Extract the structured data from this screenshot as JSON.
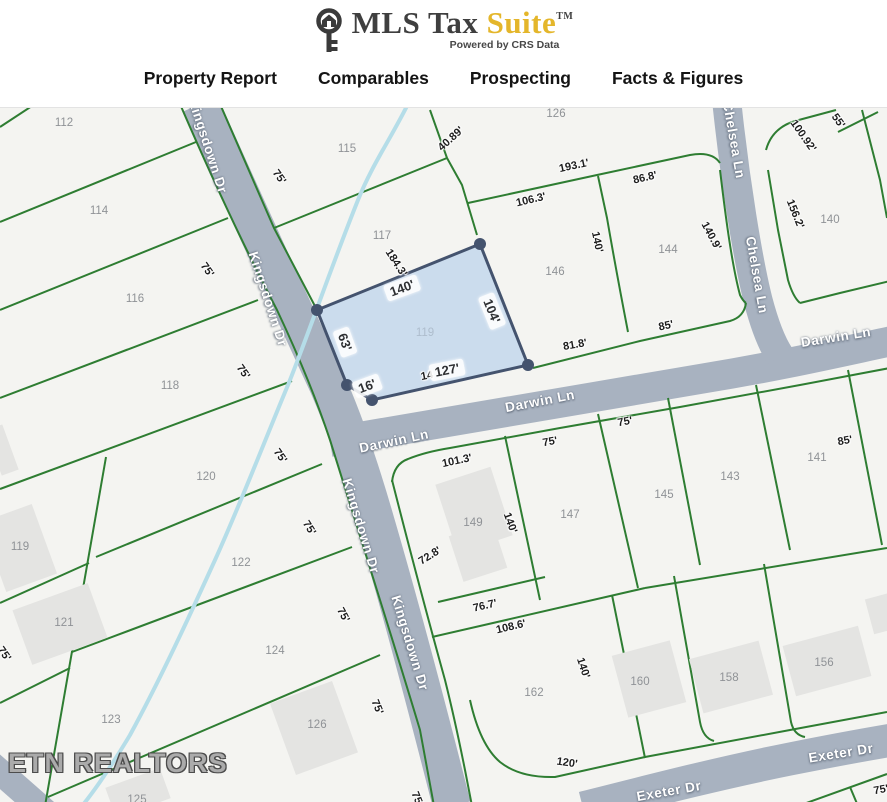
{
  "header": {
    "logo": {
      "brand_primary": "MLS Tax",
      "brand_accent": "Suite",
      "trademark": "TM",
      "tagline": "Powered by CRS Data"
    },
    "nav": [
      {
        "label": "Property Report"
      },
      {
        "label": "Comparables"
      },
      {
        "label": "Prospecting"
      },
      {
        "label": "Facts & Figures"
      }
    ]
  },
  "map": {
    "watermark": "ETN REALTORS",
    "selected_parcel": {
      "number": "119",
      "frontage_street": "Darwin Ln",
      "dimensions": [
        "140'",
        "104'",
        "127'",
        "16'",
        "63'"
      ]
    },
    "colors": {
      "accent_gold": "#e4b62b",
      "road": "#a8b2c0",
      "parcel_line": "#2e7d32",
      "creek": "#b5dde8",
      "selection_fill": "#a9c9ea",
      "selection_border": "#44536e",
      "map_background": "#f4f4f1"
    },
    "streets": [
      {
        "name": "Kingsdown Dr",
        "labels": [
          [
            208,
            146,
            72
          ],
          [
            268,
            299,
            72
          ],
          [
            361,
            526,
            73
          ],
          [
            410,
            643,
            73
          ]
        ]
      },
      {
        "name": "Darwin Ln",
        "labels": [
          [
            394,
            441,
            -12
          ],
          [
            540,
            401,
            -11
          ],
          [
            836,
            337,
            -9
          ]
        ]
      },
      {
        "name": "Chelsea Ln",
        "labels": [
          [
            734,
            140,
            80
          ],
          [
            757,
            275,
            80
          ]
        ]
      },
      {
        "name": "Exeter Dr",
        "labels": [
          [
            841,
            753,
            -9
          ],
          [
            669,
            791,
            -10
          ]
        ]
      }
    ],
    "parcel_numbers": [
      {
        "n": "112",
        "x": 64,
        "y": 123
      },
      {
        "n": "114",
        "x": 99,
        "y": 211
      },
      {
        "n": "115",
        "x": 347,
        "y": 149
      },
      {
        "n": "116",
        "x": 135,
        "y": 299
      },
      {
        "n": "117",
        "x": 382,
        "y": 236
      },
      {
        "n": "118",
        "x": 170,
        "y": 386
      },
      {
        "n": "119",
        "x": 20,
        "y": 547
      },
      {
        "n": "119",
        "x": 425,
        "y": 333,
        "faint": true
      },
      {
        "n": "120",
        "x": 206,
        "y": 477
      },
      {
        "n": "121",
        "x": 64,
        "y": 623
      },
      {
        "n": "122",
        "x": 241,
        "y": 563
      },
      {
        "n": "123",
        "x": 111,
        "y": 720
      },
      {
        "n": "124",
        "x": 275,
        "y": 651
      },
      {
        "n": "125",
        "x": 137,
        "y": 800
      },
      {
        "n": "126",
        "x": 556,
        "y": 114
      },
      {
        "n": "126",
        "x": 317,
        "y": 725
      },
      {
        "n": "140",
        "x": 830,
        "y": 220
      },
      {
        "n": "141",
        "x": 817,
        "y": 458
      },
      {
        "n": "143",
        "x": 730,
        "y": 477
      },
      {
        "n": "144",
        "x": 668,
        "y": 250
      },
      {
        "n": "145",
        "x": 664,
        "y": 495
      },
      {
        "n": "146",
        "x": 555,
        "y": 272
      },
      {
        "n": "147",
        "x": 570,
        "y": 515
      },
      {
        "n": "149",
        "x": 473,
        "y": 523
      },
      {
        "n": "156",
        "x": 824,
        "y": 663
      },
      {
        "n": "158",
        "x": 729,
        "y": 678
      },
      {
        "n": "160",
        "x": 640,
        "y": 682
      },
      {
        "n": "162",
        "x": 534,
        "y": 693
      }
    ],
    "dimensions": [
      {
        "t": "40.89'",
        "x": 451,
        "y": 139,
        "r": -42
      },
      {
        "t": "193.1'",
        "x": 574,
        "y": 166,
        "r": -12
      },
      {
        "t": "106.3'",
        "x": 531,
        "y": 200,
        "r": -13
      },
      {
        "t": "86.8'",
        "x": 645,
        "y": 178,
        "r": -13
      },
      {
        "t": "140'",
        "x": 597,
        "y": 242,
        "r": 78
      },
      {
        "t": "140.9'",
        "x": 711,
        "y": 236,
        "r": 62
      },
      {
        "t": "100.92'",
        "x": 803,
        "y": 136,
        "r": 55
      },
      {
        "t": "55'",
        "x": 838,
        "y": 121,
        "r": 55
      },
      {
        "t": "156.2'",
        "x": 795,
        "y": 214,
        "r": 68
      },
      {
        "t": "85'",
        "x": 666,
        "y": 326,
        "r": -12
      },
      {
        "t": "81.8'",
        "x": 575,
        "y": 345,
        "r": -10
      },
      {
        "t": "184.3'",
        "x": 396,
        "y": 263,
        "r": 57
      },
      {
        "t": "14",
        "x": 427,
        "y": 376,
        "r": -11
      },
      {
        "t": "140'",
        "x": 402,
        "y": 288,
        "r": -20,
        "boxed": true
      },
      {
        "t": "104'",
        "x": 492,
        "y": 311,
        "r": 68,
        "boxed": true
      },
      {
        "t": "63'",
        "x": 345,
        "y": 342,
        "r": 70,
        "boxed": true
      },
      {
        "t": "16'",
        "x": 367,
        "y": 386,
        "r": -20,
        "boxed": true
      },
      {
        "t": "127'",
        "x": 447,
        "y": 370,
        "r": -11,
        "boxed": true
      },
      {
        "t": "75'",
        "x": 279,
        "y": 177,
        "r": 55
      },
      {
        "t": "75'",
        "x": 207,
        "y": 270,
        "r": 55
      },
      {
        "t": "75'",
        "x": 243,
        "y": 372,
        "r": 55
      },
      {
        "t": "75'",
        "x": 280,
        "y": 456,
        "r": 55
      },
      {
        "t": "75'",
        "x": 309,
        "y": 528,
        "r": 58
      },
      {
        "t": "75'",
        "x": 343,
        "y": 615,
        "r": 62
      },
      {
        "t": "75'",
        "x": 377,
        "y": 707,
        "r": 68
      },
      {
        "t": "75'",
        "x": 417,
        "y": 799,
        "r": 68
      },
      {
        "t": "75'",
        "x": 4,
        "y": 654,
        "r": 55
      },
      {
        "t": "101.3'",
        "x": 457,
        "y": 461,
        "r": -12
      },
      {
        "t": "75'",
        "x": 550,
        "y": 442,
        "r": -10
      },
      {
        "t": "75'",
        "x": 625,
        "y": 422,
        "r": -10
      },
      {
        "t": "85'",
        "x": 845,
        "y": 441,
        "r": -10
      },
      {
        "t": "72.8'",
        "x": 430,
        "y": 556,
        "r": -32
      },
      {
        "t": "140'",
        "x": 510,
        "y": 523,
        "r": 70
      },
      {
        "t": "76.7'",
        "x": 485,
        "y": 606,
        "r": -13
      },
      {
        "t": "108.6'",
        "x": 511,
        "y": 627,
        "r": -13
      },
      {
        "t": "140'",
        "x": 583,
        "y": 668,
        "r": 72
      },
      {
        "t": "120'",
        "x": 567,
        "y": 763,
        "r": 8
      },
      {
        "t": "75'",
        "x": 881,
        "y": 790,
        "r": -10
      }
    ]
  }
}
